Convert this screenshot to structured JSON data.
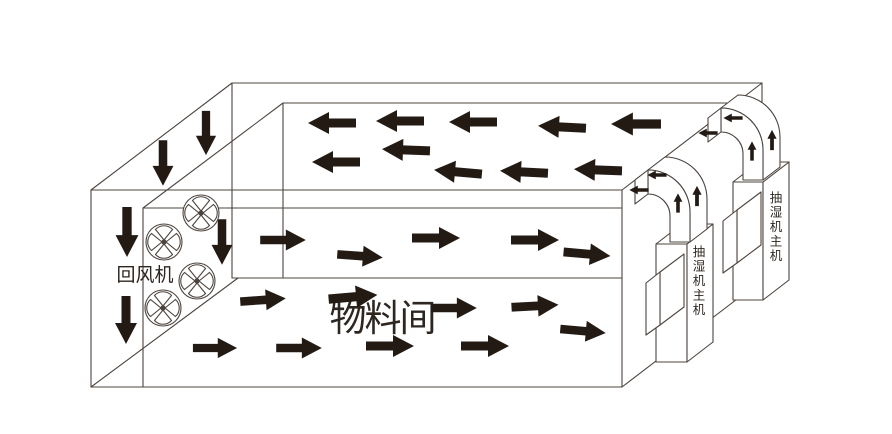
{
  "labels": {
    "material_room": "物料间",
    "return_fan": "回风机",
    "dehumidifier_unit": "抽湿机主机"
  },
  "colors": {
    "background": "#ffffff",
    "line": "#4d443e",
    "arrow": "#231a14",
    "text": "#2e2620"
  },
  "fans": [
    {
      "x": 201,
      "y": 213
    },
    {
      "x": 164,
      "y": 242
    },
    {
      "x": 197,
      "y": 281
    },
    {
      "x": 163,
      "y": 308
    }
  ],
  "flow_arrows": {
    "ceiling_return": [
      {
        "x": 332,
        "y": 123,
        "rot": 180,
        "s": 1.0
      },
      {
        "x": 400,
        "y": 121,
        "rot": 180,
        "s": 1.0
      },
      {
        "x": 473,
        "y": 122,
        "rot": 180,
        "s": 1.0
      },
      {
        "x": 562,
        "y": 127,
        "rot": 183,
        "s": 1.0
      },
      {
        "x": 636,
        "y": 124,
        "rot": 180,
        "s": 1.04
      },
      {
        "x": 336,
        "y": 162,
        "rot": 180,
        "s": 1.0
      },
      {
        "x": 406,
        "y": 150,
        "rot": 182,
        "s": 1.0
      },
      {
        "x": 458,
        "y": 172,
        "rot": 185,
        "s": 1.0
      },
      {
        "x": 524,
        "y": 172,
        "rot": 183,
        "s": 1.0
      },
      {
        "x": 598,
        "y": 170,
        "rot": 182,
        "s": 1.0
      }
    ],
    "mid_supply": [
      {
        "x": 283,
        "y": 240,
        "rot": 0,
        "s": 0.95
      },
      {
        "x": 360,
        "y": 256,
        "rot": 4,
        "s": 0.95
      },
      {
        "x": 436,
        "y": 238,
        "rot": 0,
        "s": 1.0
      },
      {
        "x": 535,
        "y": 240,
        "rot": 0,
        "s": 1.0
      },
      {
        "x": 587,
        "y": 254,
        "rot": 5,
        "s": 0.98
      }
    ],
    "floor_supply": [
      {
        "x": 263,
        "y": 300,
        "rot": -4,
        "s": 0.95
      },
      {
        "x": 353,
        "y": 297,
        "rot": -5,
        "s": 1.02
      },
      {
        "x": 454,
        "y": 308,
        "rot": 0,
        "s": 0.95
      },
      {
        "x": 535,
        "y": 306,
        "rot": -3,
        "s": 0.98
      },
      {
        "x": 583,
        "y": 331,
        "rot": 5,
        "s": 0.95
      },
      {
        "x": 215,
        "y": 348,
        "rot": 0,
        "s": 0.92
      },
      {
        "x": 299,
        "y": 348,
        "rot": 0,
        "s": 0.95
      },
      {
        "x": 390,
        "y": 346,
        "rot": 0,
        "s": 1.0
      },
      {
        "x": 485,
        "y": 346,
        "rot": 0,
        "s": 1.0
      }
    ],
    "down_intake": [
      {
        "x": 163,
        "y": 163,
        "rot": 90,
        "s": 0.95
      },
      {
        "x": 206,
        "y": 133,
        "rot": 90,
        "s": 0.92
      },
      {
        "x": 127,
        "y": 232,
        "rot": 90,
        "s": 1.04
      },
      {
        "x": 126,
        "y": 320,
        "rot": 90,
        "s": 1.0
      },
      {
        "x": 222,
        "y": 242,
        "rot": 90,
        "s": 0.95
      }
    ]
  },
  "duct_arrows": [
    {
      "x": 678,
      "y": 203,
      "rot": -90,
      "s": 0.4
    },
    {
      "x": 697,
      "y": 196,
      "rot": -90,
      "s": 0.42
    },
    {
      "x": 657,
      "y": 175,
      "rot": 180,
      "s": 0.4
    },
    {
      "x": 639,
      "y": 190,
      "rot": 180,
      "s": 0.4
    },
    {
      "x": 752,
      "y": 151,
      "rot": -90,
      "s": 0.4
    },
    {
      "x": 772,
      "y": 140,
      "rot": -90,
      "s": 0.42
    },
    {
      "x": 733,
      "y": 118,
      "rot": 180,
      "s": 0.4
    },
    {
      "x": 708,
      "y": 133,
      "rot": 180,
      "s": 0.4
    }
  ]
}
